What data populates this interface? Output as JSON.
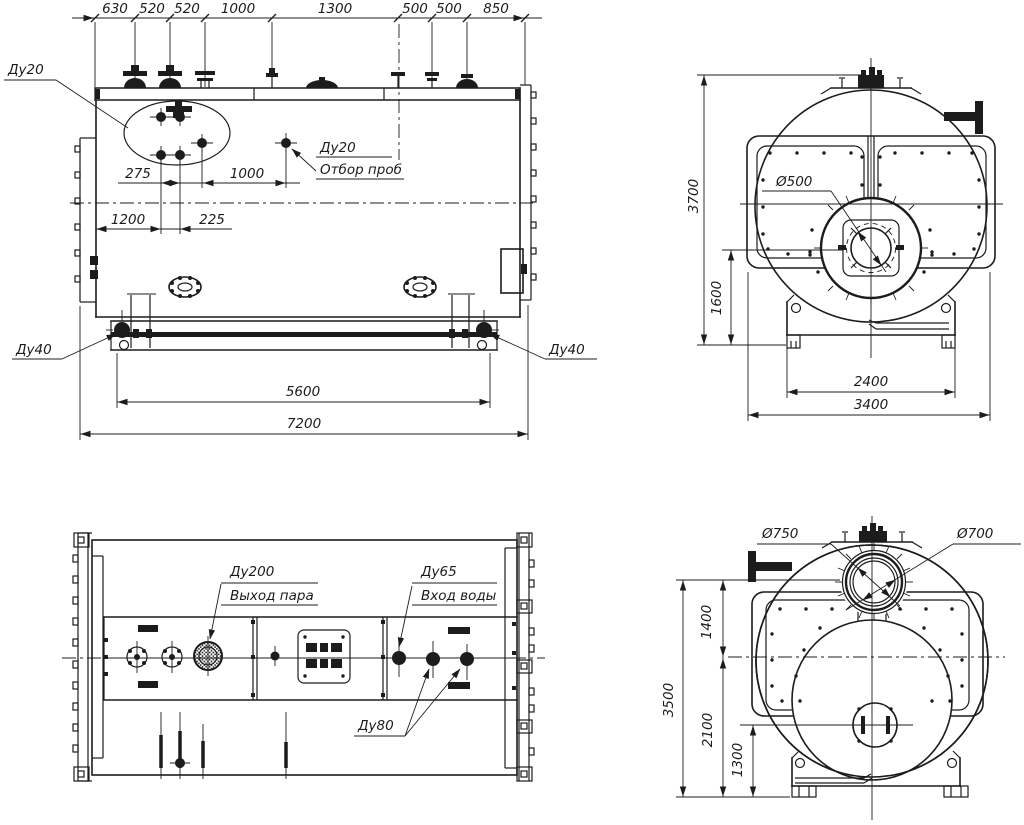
{
  "canvas": {
    "background": "#ffffff",
    "line_color": "#1c1c1c"
  },
  "side_view": {
    "top_dim_chain": [
      "630",
      "520",
      "520",
      "1000",
      "1300",
      "500",
      "500",
      "850"
    ],
    "dim_275": "275",
    "dim_1000": "1000",
    "dim_1200": "1200",
    "dim_225": "225",
    "dim_5600": "5600",
    "dim_7200": "7200",
    "label_du20": "Ду20",
    "sample_label_size": "Ду20",
    "sample_label_text": "Отбор проб",
    "label_du40_left": "Ду40",
    "label_du40_right": "Ду40"
  },
  "front_view": {
    "dim_3700": "3700",
    "dim_1600": "1600",
    "dim_2400": "2400",
    "dim_3400": "3400",
    "label_d500": "Ø500"
  },
  "plan_view": {
    "label_du200": "Ду200",
    "label_steam_out": "Выход пара",
    "label_du65": "Ду65",
    "label_water_in": "Вход воды",
    "label_du80": "Ду80"
  },
  "rear_view": {
    "dim_1400": "1400",
    "dim_2100": "2100",
    "dim_1300": "1300",
    "dim_3500": "3500",
    "label_d750": "Ø750",
    "label_d700": "Ø700"
  }
}
